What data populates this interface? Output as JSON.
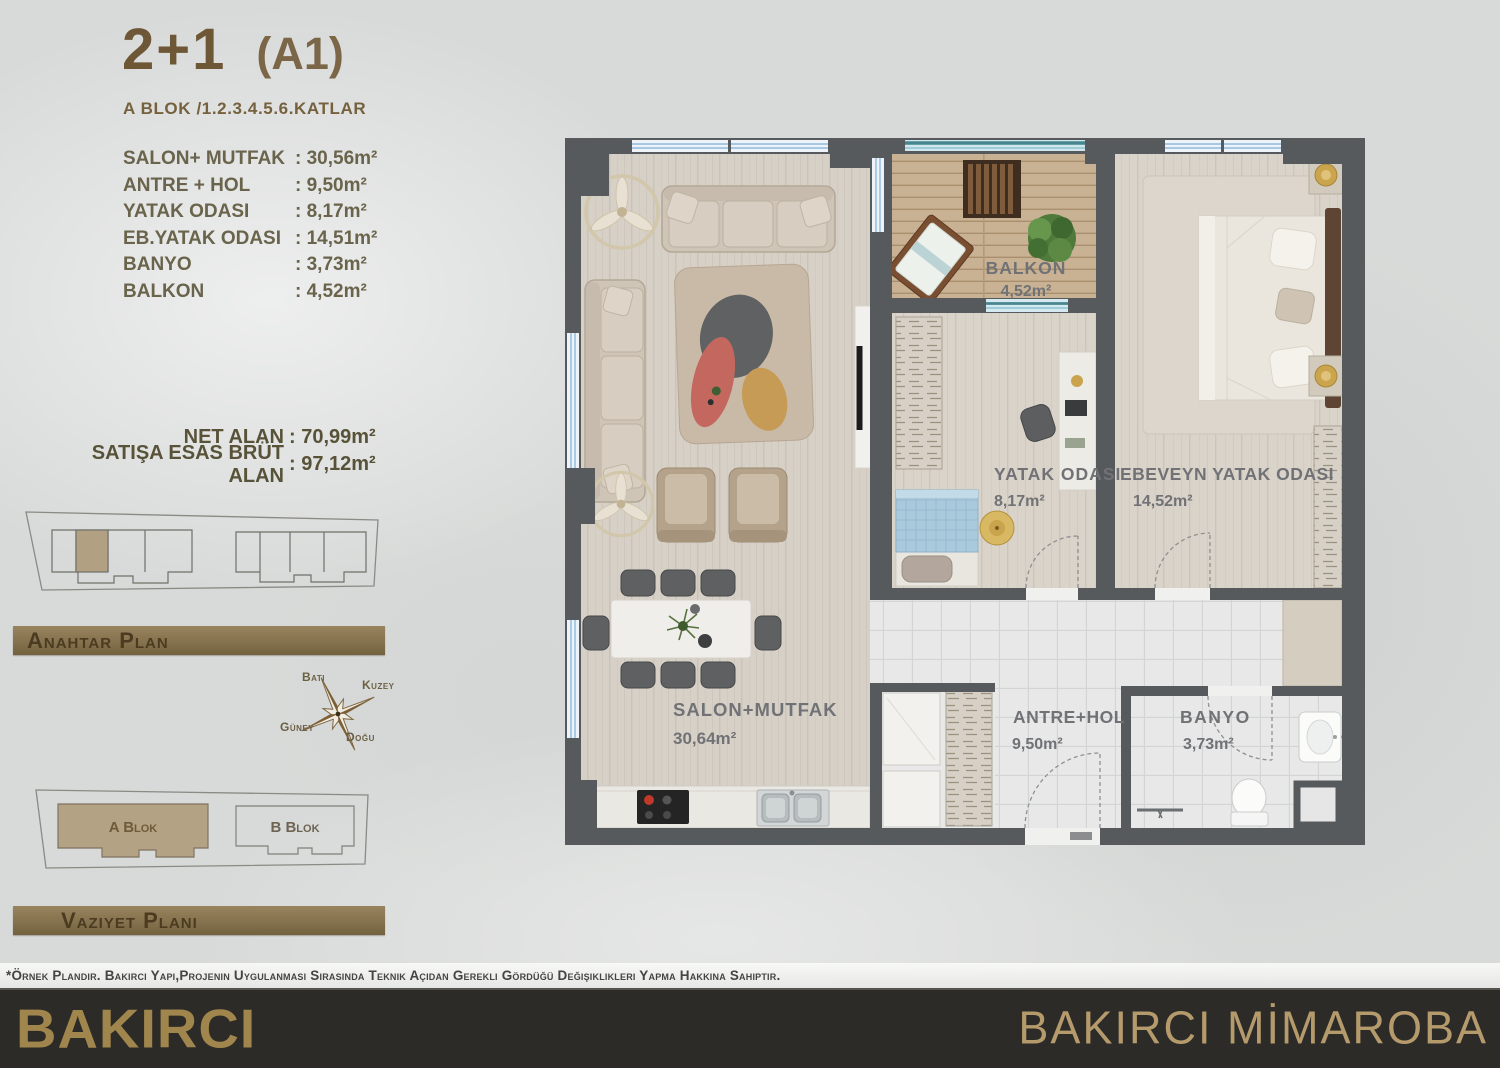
{
  "header": {
    "title": "2+1",
    "unit_code": "(A1)",
    "block_floors": "A BLOK /1.2.3.4.5.6.KATLAR"
  },
  "area_table": {
    "rows": [
      {
        "label": "SALON+ MUTFAK",
        "value": ": 30,56m²"
      },
      {
        "label": "ANTRE + HOL",
        "value": ": 9,50m²"
      },
      {
        "label": "YATAK ODASI",
        "value": ": 8,17m²"
      },
      {
        "label": "EB.YATAK ODASI",
        "value": ": 14,51m²"
      },
      {
        "label": "BANYO",
        "value": ": 3,73m²"
      },
      {
        "label": "BALKON",
        "value": ": 4,52m²"
      }
    ]
  },
  "totals": {
    "net": {
      "label": "NET ALAN",
      "value": ": 70,99m²"
    },
    "gross": {
      "label": "SATIŞA ESAS BRÜT ALAN",
      "value": ": 97,12m²"
    }
  },
  "key_plan": {
    "caption": "Anahtar Plan"
  },
  "compass": {
    "west": "Batı",
    "north": "Kuzey",
    "south": "Güney",
    "east": "Doğu"
  },
  "site_plan": {
    "caption": "Vazıyet Planı",
    "blocks": [
      "A Blok",
      "B Blok"
    ]
  },
  "floor_plan": {
    "rooms": [
      {
        "name": "BALKON",
        "area": "4,52m²"
      },
      {
        "name": "YATAK ODASI",
        "area": "8,17m²"
      },
      {
        "name": "EBEVEYN YATAK ODASI",
        "area": "14,52m²"
      },
      {
        "name": "SALON+MUTFAK",
        "area": "30,64m²"
      },
      {
        "name": "ANTRE+HOL",
        "area": "9,50m²"
      },
      {
        "name": "BANYO",
        "area": "3,73m²"
      }
    ]
  },
  "footer": {
    "disclaimer": "*Örnek Plandır. Bakırcı Yapı,Projenin Uygulanması Sırasında Teknik Açıdan Gerekli Gördüğü Değişiklikleri Yapma Hakkına Sahiptir.",
    "brand_left": "BAKIRCI",
    "brand_right": "BAKIRCI MİMAROBA"
  },
  "colors": {
    "accent_brown": "#7a654a",
    "bar_brown": "#83704c",
    "wall_gray": "#565a5d",
    "footer_bg": "#2c2b28",
    "gold": "#c9a44c",
    "window_blue": "#8fb9da",
    "balcony_teal": "#47858f"
  }
}
